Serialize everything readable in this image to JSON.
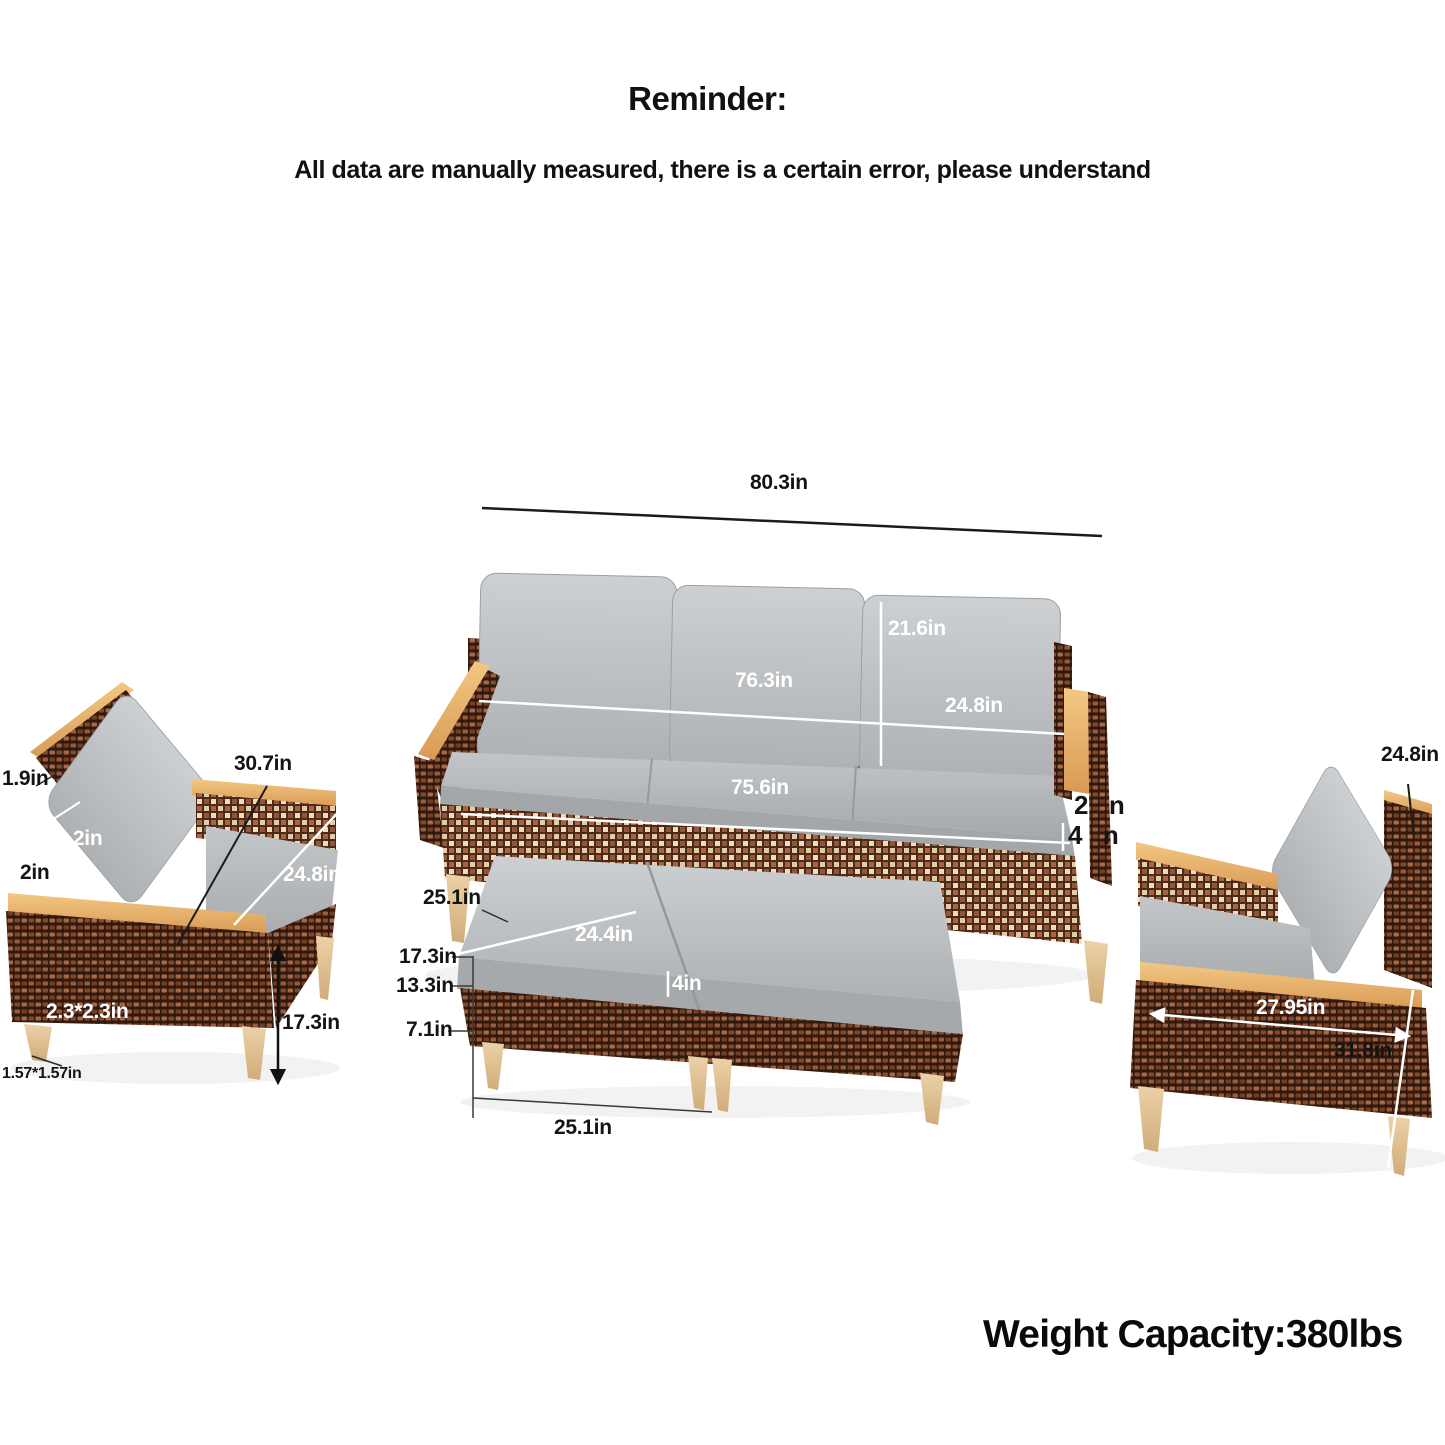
{
  "header": {
    "title": "Reminder:",
    "subtitle": "All data are manually measured, there is a certain error, please understand"
  },
  "footer": {
    "weight_capacity": "Weight Capacity:380lbs"
  },
  "colors": {
    "wicker_dark": "#31190e",
    "wicker_light": "#a76440",
    "cushion_gray": "#b7babc",
    "wood": "#e8b36b",
    "leg_tan": "#e2c493",
    "label_black": "#141414",
    "label_white": "#ffffff"
  },
  "sofa": {
    "overall_width": "80.3in",
    "back_cushion_height": "21.6in",
    "back_width": "76.3in",
    "back_cushion_width": "24.8in",
    "seat_width": "75.6in",
    "cropped_label_top": "2   n",
    "cropped_label_bottom": "4   n"
  },
  "left_chair": {
    "back_frame_thickness": "1.9in",
    "overall_width": "30.7in",
    "cushion_thickness": "3.2in",
    "arm_thickness": "2in",
    "seat_depth": "24.8in",
    "leg_top_size": "2.3*2.3in",
    "leg_section_height": "17.3in",
    "leg_bottom_size": "1.57*1.57in"
  },
  "ottoman": {
    "top_depth": "25.1in",
    "cushion_width": "24.4in",
    "overall_height": "17.3in",
    "base_height": "13.3in",
    "cushion_thickness": "4in",
    "leg_height": "7.1in",
    "bottom_width": "25.1in"
  },
  "right_chair": {
    "back_cushion_width": "24.8in",
    "front_width": "27.95in",
    "overall_height": "31.8in"
  }
}
